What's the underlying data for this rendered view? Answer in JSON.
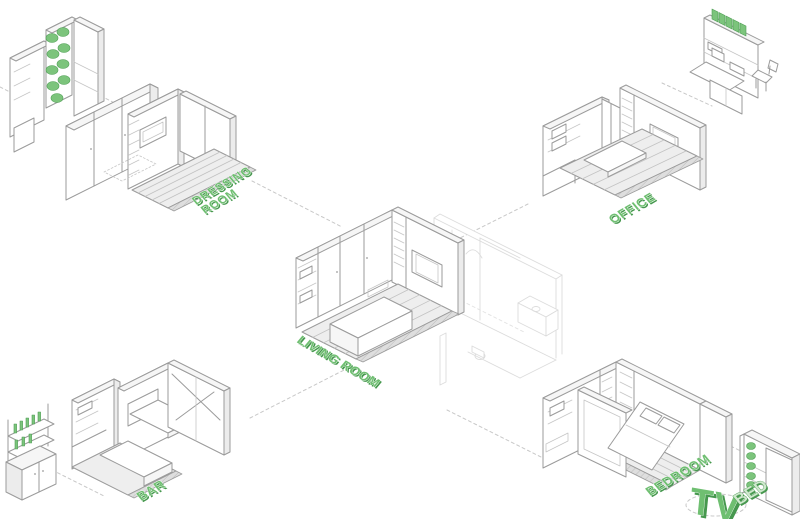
{
  "colors": {
    "accent_green": "#6fbf71",
    "accent_green_dark": "#46984e",
    "accent_green_light": "#cfe8cd",
    "line_gray": "#9b9b9b"
  },
  "labels": {
    "dressing_room": {
      "line1": "DRESSING",
      "line2": "ROOM"
    },
    "office": "OFFICE",
    "living_room": "LIVING ROOM",
    "bar": "BAR",
    "bedroom": "BEDROOM",
    "tv": "TV",
    "bed": "BED"
  }
}
